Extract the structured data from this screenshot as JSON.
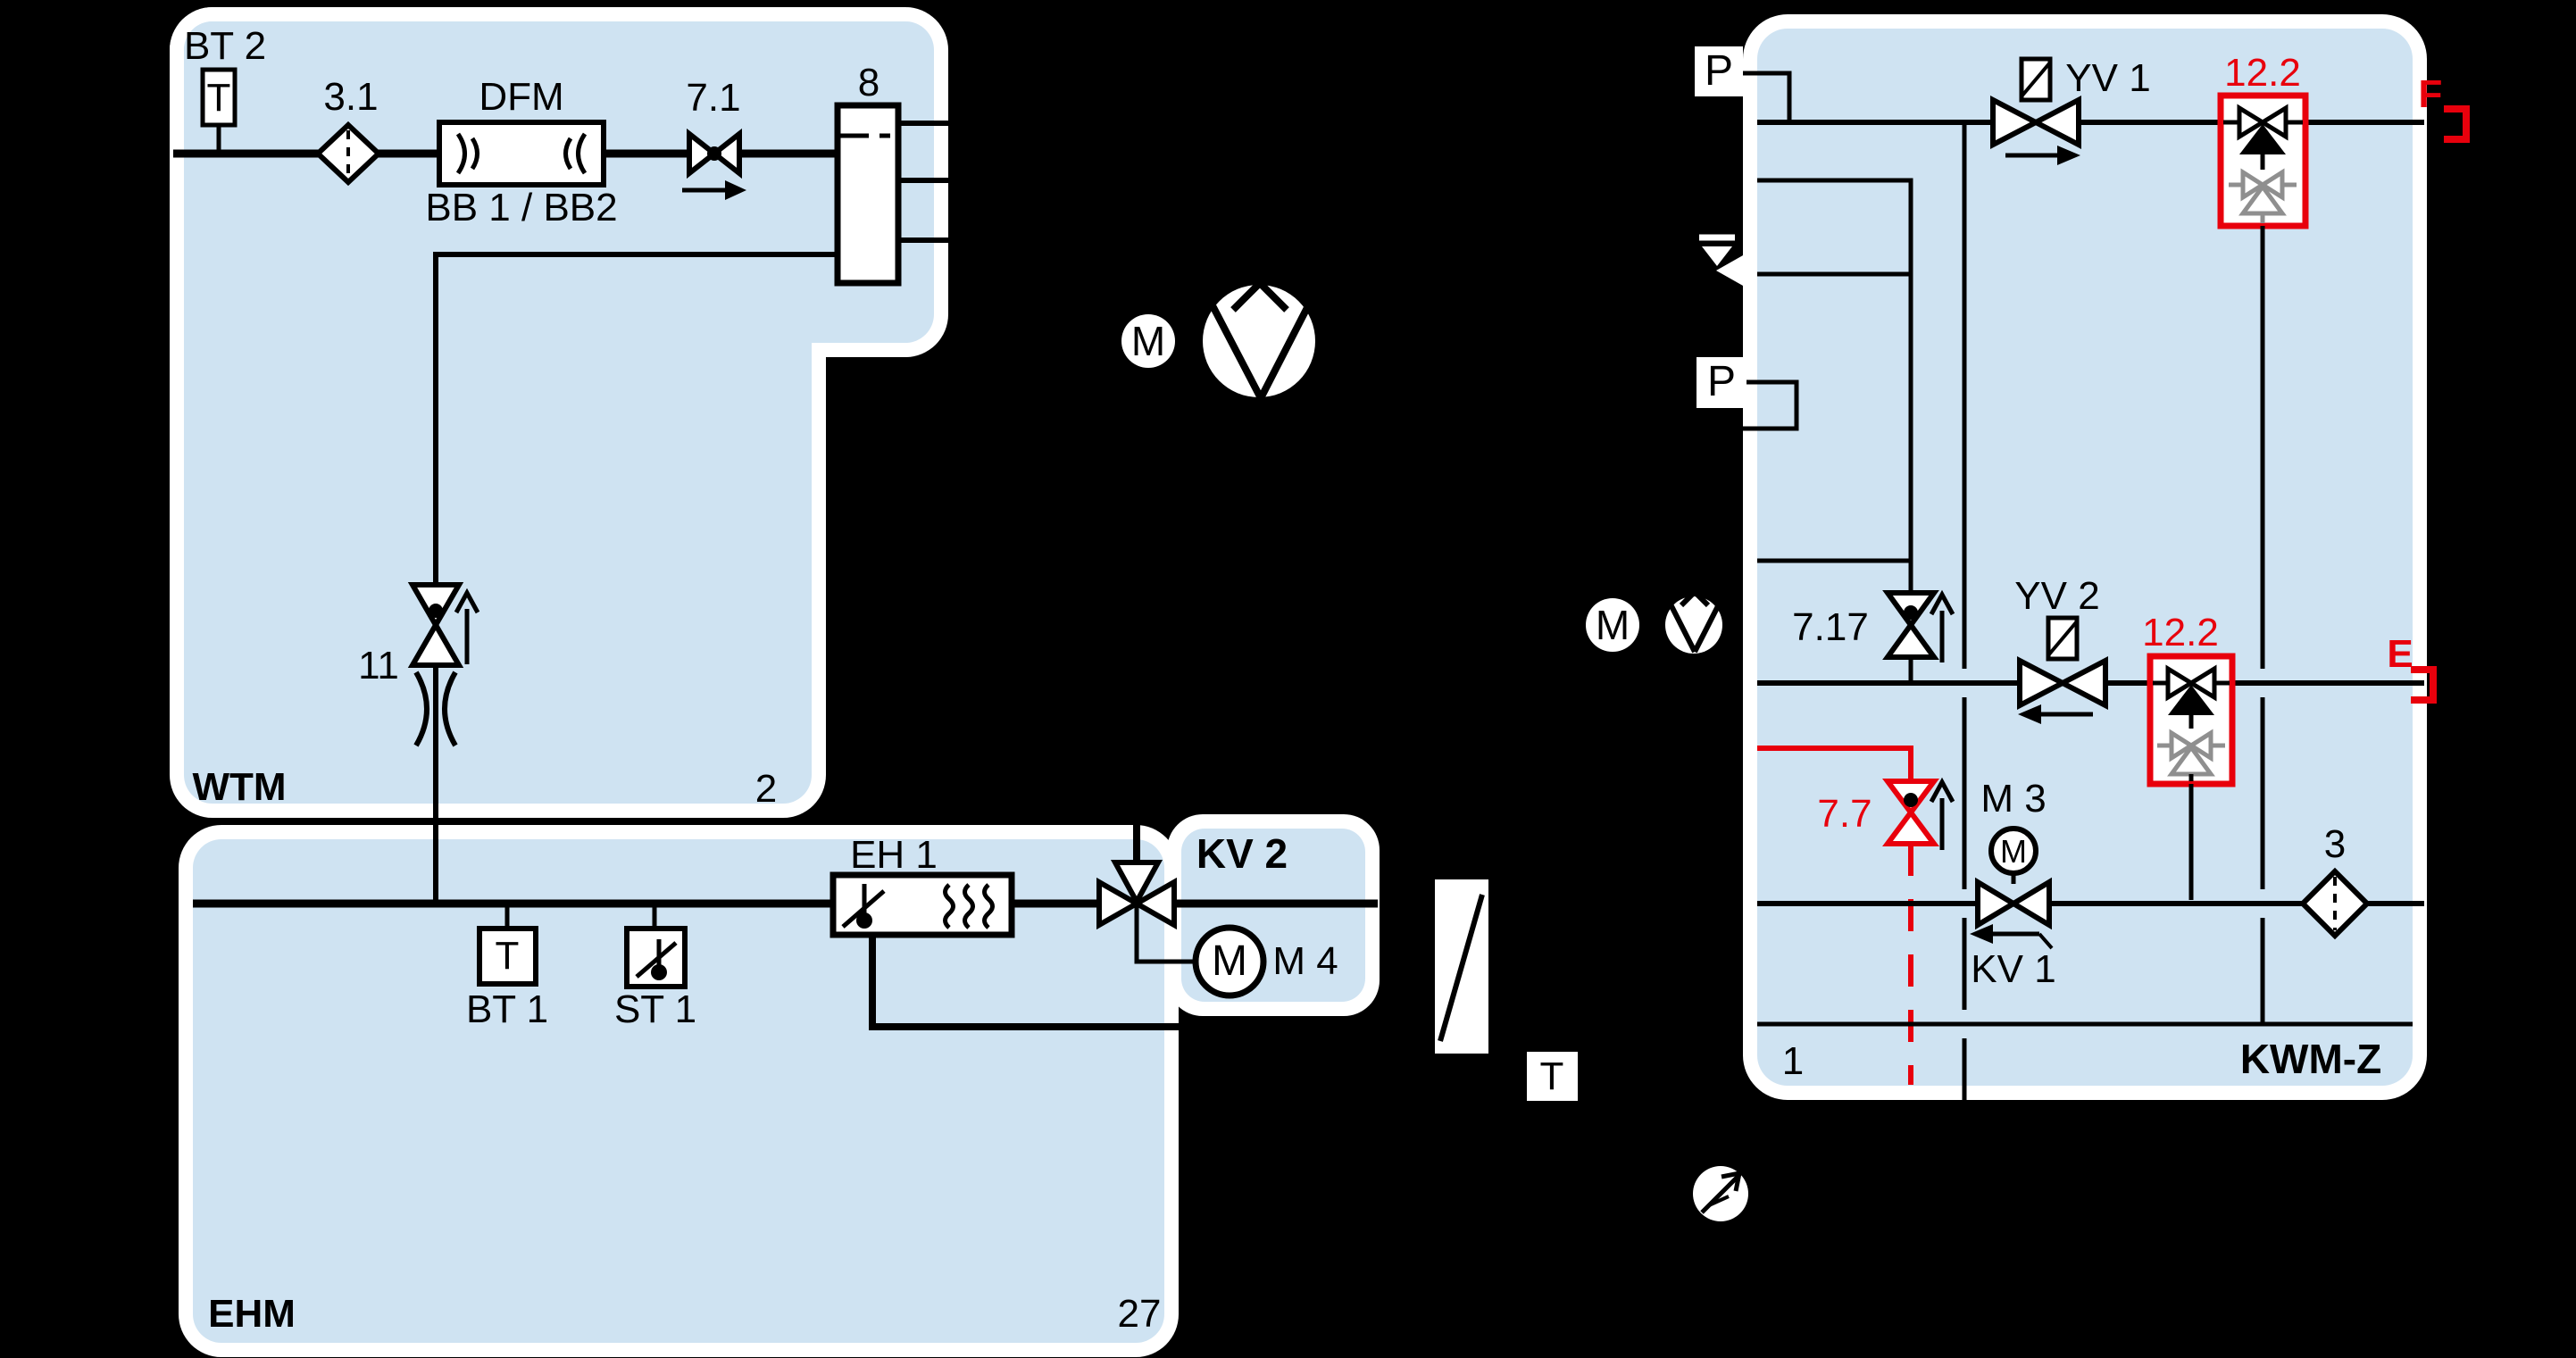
{
  "diagram": {
    "kind": "piping-instrumentation-schematic",
    "colors": {
      "background": "#000000",
      "panel_fill": "#cfe3f2",
      "panel_border": "#ffffff",
      "line": "#000000",
      "alarm_red": "#e8000c",
      "inactive_gray": "#8f8f8f"
    }
  },
  "panels": {
    "wtm": {
      "name": "WTM",
      "corner_number": "2"
    },
    "ehm": {
      "name": "EHM",
      "corner_number": "27"
    },
    "kv2": {
      "name": "KV 2"
    },
    "kwmz": {
      "name": "KWM-Z",
      "corner_number": "1"
    }
  },
  "labels": {
    "bt2": "BT 2",
    "v31": "3.1",
    "dfm": "DFM",
    "bb": "BB 1 / BB2",
    "v71": "7.1",
    "hx8": "8",
    "v11": "11",
    "wtm": "WTM",
    "n2": "2",
    "eh1": "EH 1",
    "bt1": "BT 1",
    "st1": "ST 1",
    "kv2": "KV 2",
    "m4": "M 4",
    "ehm": "EHM",
    "n27": "27",
    "yv1": "YV 1",
    "q122a": "12.2",
    "f": "F",
    "v717": "7.17",
    "yv2": "YV 2",
    "q122b": "12.2",
    "e": "E",
    "v77": "7.7",
    "m3": "M 3",
    "kv1": "KV 1",
    "n3": "3",
    "n1": "1",
    "kwmz": "KWM-Z",
    "letter_p": "P",
    "letter_t": "T",
    "letter_m": "M"
  }
}
